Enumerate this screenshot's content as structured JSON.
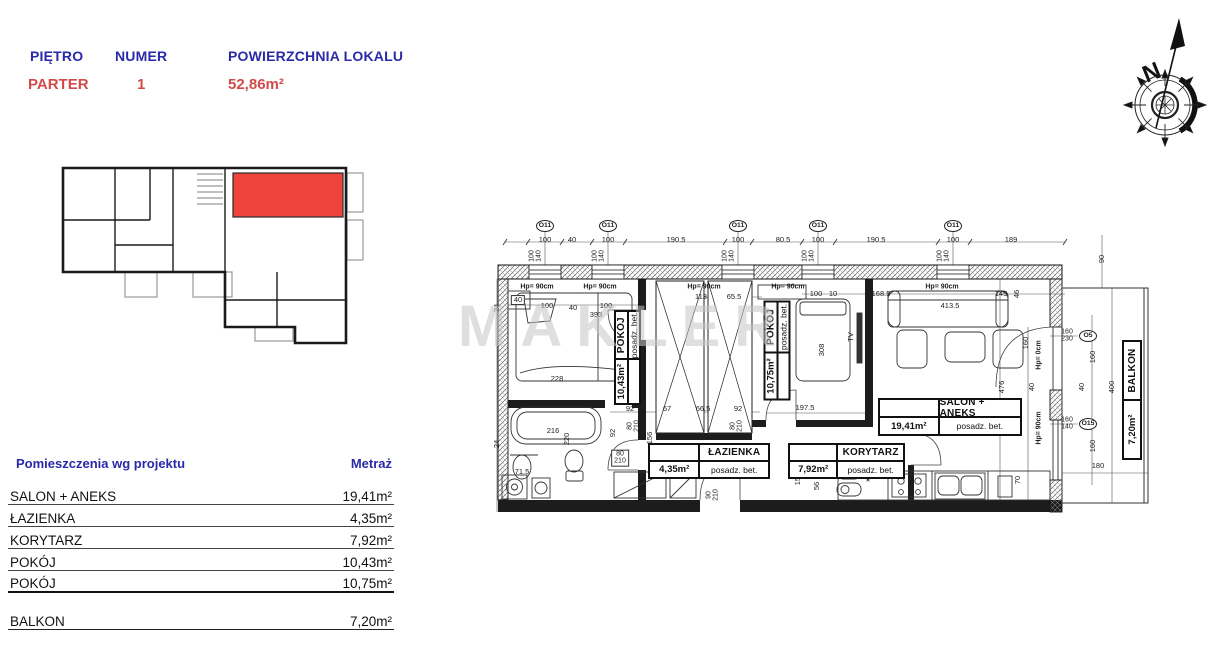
{
  "header": {
    "floor_label": "PIĘTRO",
    "number_label": "NUMER",
    "area_label": "POWIERZCHNIA LOKALU",
    "floor_value": "PARTER",
    "number_value": "1",
    "area_value": "52,86m²",
    "label_color": "#2a2aa8",
    "value_color": "#d14b48"
  },
  "watermark": "MAKLER",
  "compass": {
    "north_letter": "N"
  },
  "mini_plan": {
    "highlight_color": "#ee423d"
  },
  "rooms_table": {
    "col_room": "Pomieszczenia wg projektu",
    "col_area": "Metraż",
    "rows": [
      {
        "name": "SALON + ANEKS",
        "area": "19,41m²"
      },
      {
        "name": "ŁAZIENKA",
        "area": "4,35m²"
      },
      {
        "name": "KORYTARZ",
        "area": "7,92m²"
      },
      {
        "name": "POKÓJ",
        "area": "10,43m²"
      },
      {
        "name": "POKÓJ",
        "area": "10,75m²"
      }
    ],
    "balcony_row": {
      "name": "BALKON",
      "area": "7,20m²"
    }
  },
  "floorplan": {
    "room_labels": [
      {
        "name": "ŁAZIENKA",
        "area": "4,35m²",
        "floor": "posadz. bet."
      },
      {
        "name": "KORYTARZ",
        "area": "7,92m²",
        "floor": "posadz. bet."
      },
      {
        "name": "SALON + ANEKS",
        "area": "19,41m²",
        "floor": "posadz. bet."
      }
    ],
    "vertical_room_labels": [
      {
        "name": "POKÓJ",
        "area": "10,43m²",
        "floor": "posadz. bet."
      },
      {
        "name": "POKÓJ",
        "area": "10,75m²",
        "floor": "posadz. bet."
      }
    ],
    "balcony_label": {
      "name": "BALKON",
      "area": "7,20m²"
    },
    "annotations": [
      {
        "t": "100",
        "x": 65,
        "y": 25
      },
      {
        "t": "40",
        "x": 92,
        "y": 25
      },
      {
        "t": "100",
        "x": 128,
        "y": 25
      },
      {
        "t": "190.5",
        "x": 196,
        "y": 25
      },
      {
        "t": "100",
        "x": 258,
        "y": 25
      },
      {
        "t": "80.5",
        "x": 303,
        "y": 25
      },
      {
        "t": "100",
        "x": 338,
        "y": 25
      },
      {
        "t": "190.5",
        "x": 396,
        "y": 25
      },
      {
        "t": "100",
        "x": 473,
        "y": 25
      },
      {
        "t": "189",
        "x": 531,
        "y": 25
      },
      {
        "t": "O11",
        "x": 65,
        "y": 11,
        "c": "wc"
      },
      {
        "t": "O11",
        "x": 128,
        "y": 11,
        "c": "wc"
      },
      {
        "t": "O11",
        "x": 258,
        "y": 11,
        "c": "wc"
      },
      {
        "t": "O11",
        "x": 338,
        "y": 11,
        "c": "wc"
      },
      {
        "t": "O11",
        "x": 473,
        "y": 11,
        "c": "wc"
      },
      {
        "t": "100\n140",
        "x": 56,
        "y": 41,
        "r": 1,
        "c": "pre"
      },
      {
        "t": "100\n140",
        "x": 119,
        "y": 41,
        "r": 1,
        "c": "pre"
      },
      {
        "t": "100\n140",
        "x": 249,
        "y": 41,
        "r": 1,
        "c": "pre"
      },
      {
        "t": "100\n140",
        "x": 329,
        "y": 41,
        "r": 1,
        "c": "pre"
      },
      {
        "t": "100\n140",
        "x": 464,
        "y": 41,
        "r": 1,
        "c": "pre"
      },
      {
        "t": "Hp= 90cm",
        "x": 57,
        "y": 72,
        "c": "hp"
      },
      {
        "t": "Hp= 90cm",
        "x": 120,
        "y": 72,
        "c": "hp"
      },
      {
        "t": "Hp= 90cm",
        "x": 224,
        "y": 72,
        "c": "hp"
      },
      {
        "t": "Hp= 90cm",
        "x": 308,
        "y": 72,
        "c": "hp"
      },
      {
        "t": "Hp= 90cm",
        "x": 462,
        "y": 72,
        "c": "hp"
      },
      {
        "t": "24",
        "x": 17,
        "y": 93,
        "r": 1
      },
      {
        "t": "40",
        "x": 38,
        "y": 85,
        "c": "boxed"
      },
      {
        "t": "100",
        "x": 67,
        "y": 91
      },
      {
        "t": "40",
        "x": 93,
        "y": 93
      },
      {
        "t": "100",
        "x": 126,
        "y": 91
      },
      {
        "t": "393",
        "x": 116,
        "y": 100
      },
      {
        "t": "113",
        "x": 221,
        "y": 82
      },
      {
        "t": "65.5",
        "x": 254,
        "y": 82
      },
      {
        "t": "100",
        "x": 336,
        "y": 79
      },
      {
        "t": "10",
        "x": 353,
        "y": 79
      },
      {
        "t": "168.5",
        "x": 401,
        "y": 79
      },
      {
        "t": "413.5",
        "x": 470,
        "y": 91
      },
      {
        "t": "145",
        "x": 521,
        "y": 79
      },
      {
        "t": "46",
        "x": 537,
        "y": 79,
        "r": 1
      },
      {
        "t": "228",
        "x": 77,
        "y": 164
      },
      {
        "t": "216",
        "x": 73,
        "y": 216
      },
      {
        "t": "220",
        "x": 87,
        "y": 224,
        "r": 1
      },
      {
        "t": "92",
        "x": 150,
        "y": 194
      },
      {
        "t": "67",
        "x": 187,
        "y": 194
      },
      {
        "t": "66.5",
        "x": 223,
        "y": 194
      },
      {
        "t": "92",
        "x": 258,
        "y": 194
      },
      {
        "t": "92",
        "x": 133,
        "y": 218,
        "r": 1
      },
      {
        "t": "156",
        "x": 170,
        "y": 223,
        "r": 1
      },
      {
        "t": "80\n210",
        "x": 140,
        "y": 243,
        "c": "pre boxed"
      },
      {
        "t": "80\n210",
        "x": 154,
        "y": 211,
        "r": 1,
        "c": "pre"
      },
      {
        "t": "80\n210",
        "x": 257,
        "y": 211,
        "r": 1,
        "c": "pre"
      },
      {
        "t": "71.5",
        "x": 42,
        "y": 257
      },
      {
        "t": "24",
        "x": 17,
        "y": 229,
        "r": 1
      },
      {
        "t": "90\n210",
        "x": 233,
        "y": 280,
        "r": 1,
        "c": "pre"
      },
      {
        "t": "156",
        "x": 318,
        "y": 264,
        "r": 1
      },
      {
        "t": "56",
        "x": 337,
        "y": 271,
        "r": 1
      },
      {
        "t": "197.5",
        "x": 325,
        "y": 193
      },
      {
        "t": "308",
        "x": 342,
        "y": 135,
        "r": 1
      },
      {
        "t": "TV",
        "x": 371,
        "y": 122,
        "r": 1
      },
      {
        "t": "476",
        "x": 522,
        "y": 172,
        "r": 1
      },
      {
        "t": "40",
        "x": 552,
        "y": 172,
        "r": 1
      },
      {
        "t": "160",
        "x": 546,
        "y": 128,
        "r": 1
      },
      {
        "t": "70",
        "x": 538,
        "y": 265,
        "r": 1
      },
      {
        "t": "24",
        "x": 521,
        "y": 290
      },
      {
        "t": "24",
        "x": 543,
        "y": 292
      },
      {
        "t": "Hp= 0cm",
        "x": 559,
        "y": 140,
        "r": 1,
        "c": "hp"
      },
      {
        "t": "Hp= 90cm",
        "x": 559,
        "y": 213,
        "r": 1,
        "c": "hp"
      },
      {
        "t": "160\n230",
        "x": 587,
        "y": 121,
        "c": "pre"
      },
      {
        "t": "O5",
        "x": 608,
        "y": 121,
        "c": "wc"
      },
      {
        "t": "160\n140",
        "x": 587,
        "y": 209,
        "c": "pre"
      },
      {
        "t": "O15",
        "x": 608,
        "y": 209,
        "c": "wc"
      },
      {
        "t": "90",
        "x": 622,
        "y": 44,
        "r": 1
      },
      {
        "t": "160",
        "x": 613,
        "y": 142,
        "r": 1
      },
      {
        "t": "40",
        "x": 602,
        "y": 172,
        "r": 1
      },
      {
        "t": "400",
        "x": 632,
        "y": 172,
        "r": 1
      },
      {
        "t": "160",
        "x": 613,
        "y": 231,
        "r": 1
      },
      {
        "t": "180",
        "x": 618,
        "y": 251
      },
      {
        "t": "*",
        "x": 388,
        "y": 267,
        "c": "star"
      }
    ]
  }
}
